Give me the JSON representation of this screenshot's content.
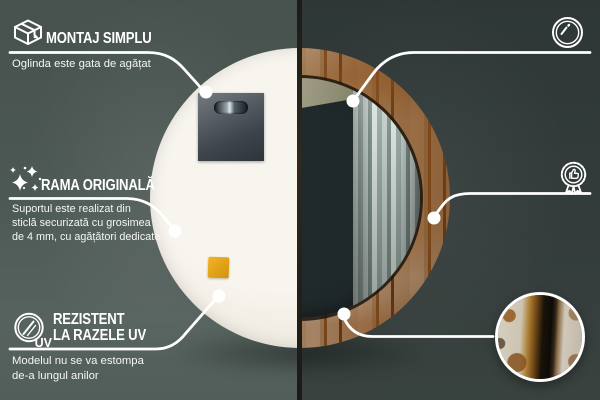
{
  "background": {
    "left_wall_color": "#4c5854",
    "right_wall_color": "#333c3b",
    "accent_color": "#ffffff",
    "sticker_color": "#e3a81b"
  },
  "callouts": {
    "montaj": {
      "icon": "package-box-icon",
      "title": "MONTAJ SIMPLU",
      "desc": [
        "Oglinda este gata de agățat"
      ]
    },
    "oglinda": {
      "icon": "mirror-shine-icon",
      "title": [
        "OGLINDĂ DE",
        "CLASĂ SUPERIOARĂ"
      ],
      "desc": [
        "O suprafață perfect netedă,",
        "care nu deformează reflexia"
      ]
    },
    "rama": {
      "icon": "sparkles-icon",
      "title": "RAMA ORIGINALĂ",
      "desc": [
        "Suportul este realizat din",
        "sticlă securizată cu grosimea",
        "de 4 mm, cu agățători dedicate"
      ]
    },
    "design": {
      "icon": "award-badge-icon",
      "title": "DESIGN UNIC",
      "desc": [
        "Design atemporal",
        "pentru orice interior"
      ]
    },
    "uv": {
      "icon": "uv-protection-icon",
      "uv_text": "UV",
      "title": [
        "REZISTENT",
        "LA RAZELE UV"
      ],
      "desc": [
        "Modelul nu se va estompa",
        "de-a lungul anilor"
      ]
    }
  }
}
